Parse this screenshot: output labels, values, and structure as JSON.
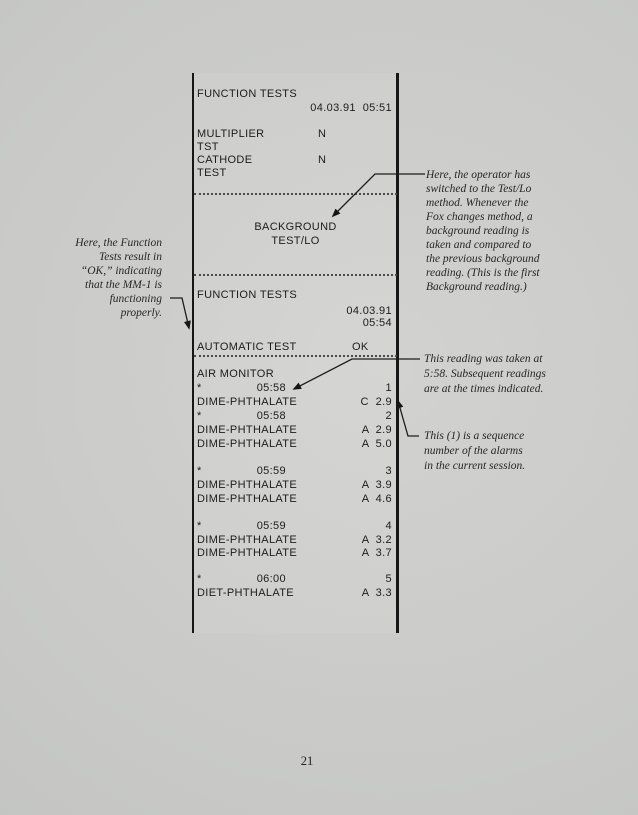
{
  "page": {
    "number": "21"
  },
  "colors": {
    "paper": "#c9cac8",
    "ink": "#1c1c1c",
    "annotation_ink": "#262626"
  },
  "printout": {
    "rows": [
      {
        "t": "left",
        "label": "FUNCTION TESTS",
        "top": 88
      },
      {
        "t": "right",
        "value": "04.03.91  05:51",
        "top": 102
      },
      {
        "t": "mid",
        "label": "MULTIPLIER",
        "mid": "N",
        "midx": 121,
        "top": 128
      },
      {
        "t": "left",
        "label": "TST",
        "top": 141
      },
      {
        "t": "mid",
        "label": "CATHODE",
        "mid": "N",
        "midx": 121,
        "top": 154
      },
      {
        "t": "left",
        "label": "TEST",
        "top": 167
      },
      {
        "t": "dotted",
        "top": 193
      },
      {
        "t": "center",
        "label": "BACKGROUND",
        "top": 221
      },
      {
        "t": "center",
        "label": "TEST/LO",
        "top": 235
      },
      {
        "t": "dotted",
        "top": 274
      },
      {
        "t": "left",
        "label": "FUNCTION TESTS",
        "top": 289
      },
      {
        "t": "right",
        "value": "04.03.91",
        "top": 305
      },
      {
        "t": "right",
        "value": "05:54",
        "top": 317
      },
      {
        "t": "mid",
        "label": "AUTOMATIC TEST",
        "mid": "OK",
        "midx": 155,
        "top": 341
      },
      {
        "t": "dotted",
        "top": 355
      },
      {
        "t": "left",
        "label": "AIR MONITOR",
        "top": 368
      },
      {
        "t": "alarm",
        "label": "*",
        "time": "05:58",
        "value": "1",
        "top": 382
      },
      {
        "t": "reading",
        "label": "DIME-PHTHALATE",
        "value": "C  2.9",
        "top": 396
      },
      {
        "t": "alarm",
        "label": "*",
        "time": "05:58",
        "value": "2",
        "top": 410
      },
      {
        "t": "reading",
        "label": "DIME-PHTHALATE",
        "value": "A  2.9",
        "top": 424
      },
      {
        "t": "reading",
        "label": "DIME-PHTHALATE",
        "value": "A  5.0",
        "top": 438
      },
      {
        "t": "alarm",
        "label": "*",
        "time": "05:59",
        "value": "3",
        "top": 465
      },
      {
        "t": "reading",
        "label": "DIME-PHTHALATE",
        "value": "A  3.9",
        "top": 479
      },
      {
        "t": "reading",
        "label": "DIME-PHTHALATE",
        "value": "A  4.6",
        "top": 493
      },
      {
        "t": "alarm",
        "label": "*",
        "time": "05:59",
        "value": "4",
        "top": 520
      },
      {
        "t": "reading",
        "label": "DIME-PHTHALATE",
        "value": "A  3.2",
        "top": 534
      },
      {
        "t": "reading",
        "label": "DIME-PHTHALATE",
        "value": "A  3.7",
        "top": 547
      },
      {
        "t": "alarm",
        "label": "*",
        "time": "06:00",
        "value": "5",
        "top": 573
      },
      {
        "t": "reading",
        "label": "DIET-PHTHALATE",
        "value": "A  3.3",
        "top": 587
      }
    ]
  },
  "annotations": {
    "function_tests": {
      "lines": [
        "Here, the Function",
        "Tests result in",
        "“OK,” indicating",
        "that the MM-1 is",
        "functioning",
        "properly."
      ]
    },
    "background": {
      "lines": [
        "Here, the operator has",
        "switched to the Test/Lo",
        "method.  Whenever the",
        "Fox changes method, a",
        "background reading is",
        "taken and compared to",
        "the previous background",
        "reading.  (This is the first",
        "Background reading.)"
      ]
    },
    "reading_time": {
      "lines": [
        "This reading was taken at",
        "5:58. Subsequent readings",
        "are at the times indicated."
      ]
    },
    "sequence": {
      "lines": [
        "This (1) is a sequence",
        "number of the alarms",
        "in the current session."
      ]
    }
  }
}
